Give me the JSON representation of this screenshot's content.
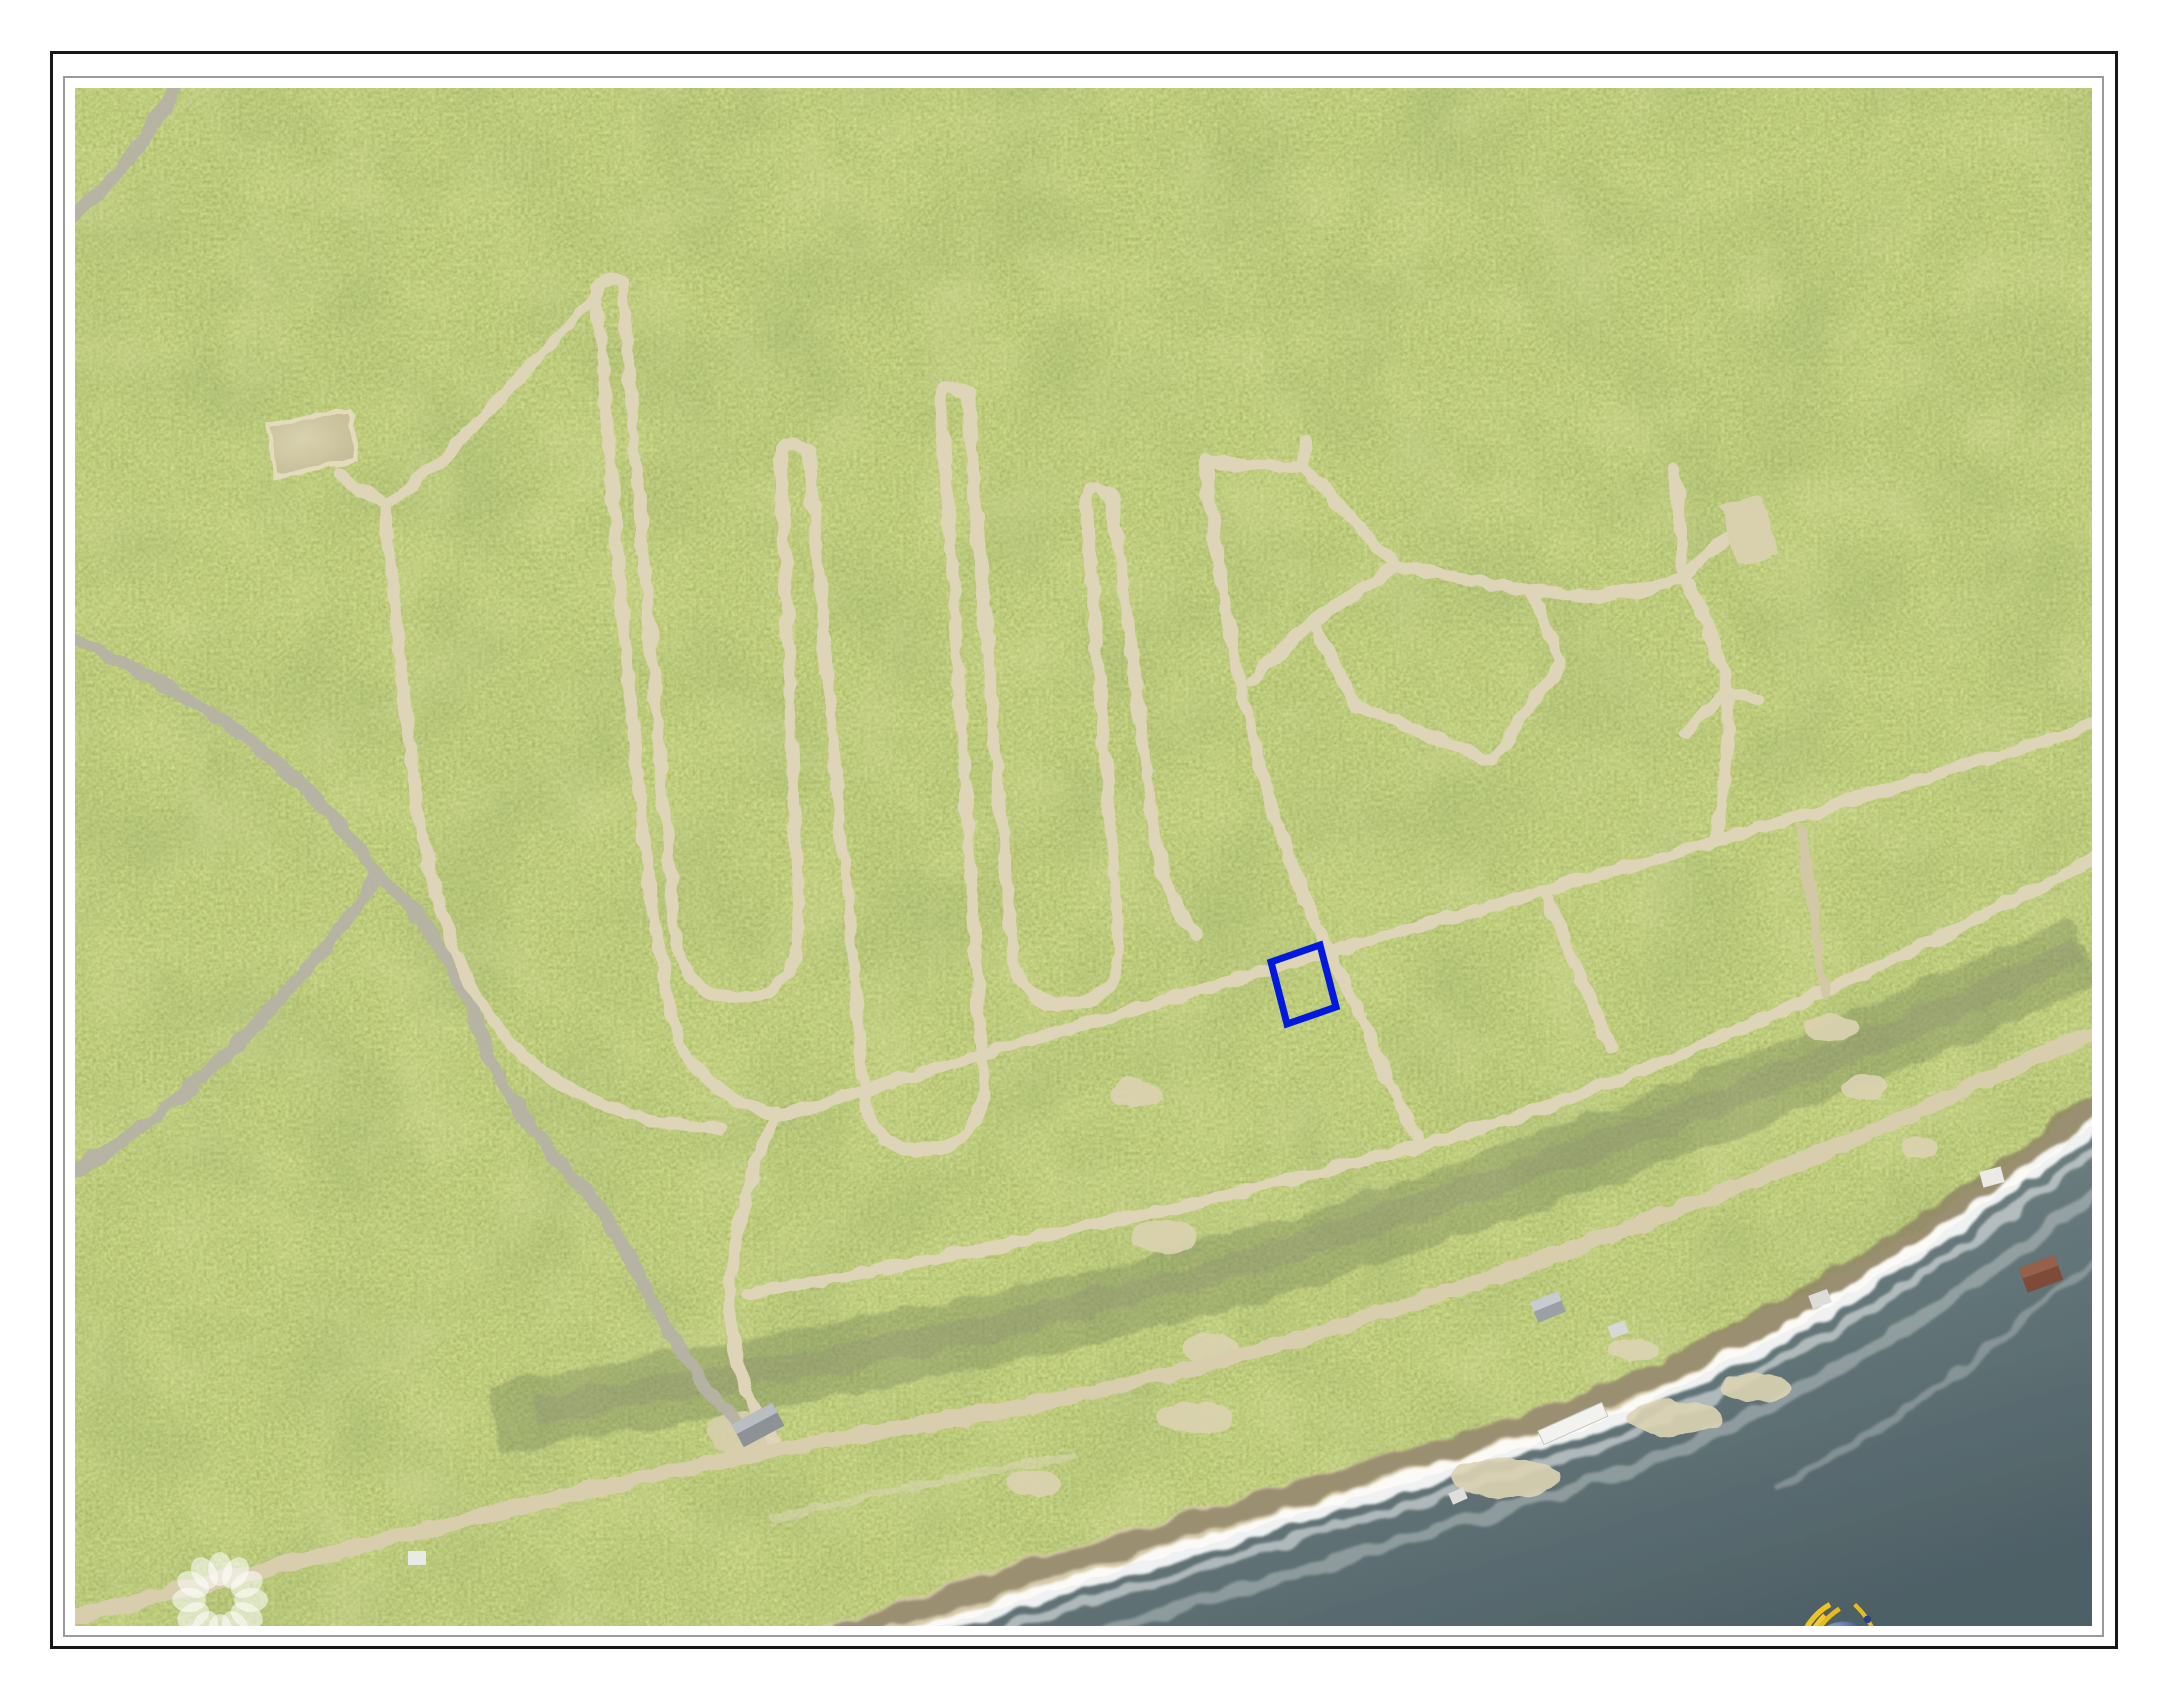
{
  "watermarks": {
    "agency": "cireba",
    "timestamp": "8/24/23 11:41 AM"
  },
  "branding": {
    "title": "CAYMAN LAND INFO",
    "website": "www.caymanlandinfo.ky",
    "title_color": "#1c3a66",
    "divider_color": "#2d5a94"
  },
  "map": {
    "type": "aerial-photo",
    "parcel_outline_color": "#0018e0",
    "vegetation_color": "#8a9b40",
    "road_color": "#ded5b8",
    "paved_road_color": "#b7b3a5",
    "sand_color": "#d6ccaa",
    "sea_color": "#5f7077"
  }
}
